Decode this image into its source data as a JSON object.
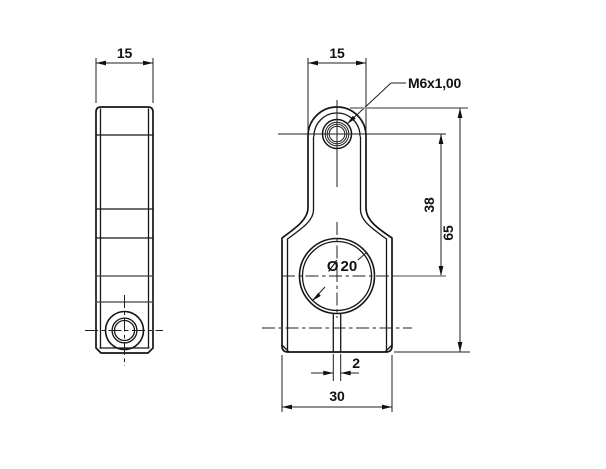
{
  "drawing": {
    "background": "#ffffff",
    "line_color": "#161616",
    "projection_color": "#999999",
    "dimensions": {
      "side_width": "15",
      "front_width": "15",
      "thread_callout": "M6x1,00",
      "center_distance": "38",
      "overall_height": "65",
      "bore_symbol": "Ø",
      "bore_value": "20",
      "slot_width": "2",
      "base_width": "30"
    }
  }
}
